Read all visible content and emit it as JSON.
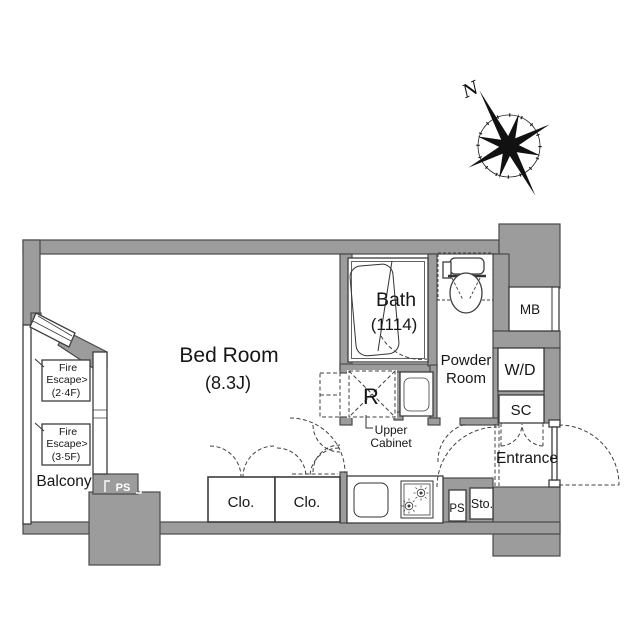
{
  "colors": {
    "wall_fill": "#9c9c9c",
    "wall_outline": "#4a4a4a",
    "line": "#333333",
    "text": "#161616",
    "background": "#ffffff"
  },
  "compass": {
    "north_label": "N"
  },
  "labels": {
    "bedroom_name": "Bed Room",
    "bedroom_size": "(8.3J)",
    "bath_name": "Bath",
    "bath_size": "(1114)",
    "powder_room_line1": "Powder",
    "powder_room_line2": "Room",
    "entrance": "Entrance",
    "balcony": "Balcony",
    "closet1": "Clo.",
    "closet2": "Clo.",
    "refrigerator": "R",
    "upper_cabinet_line1": "Upper",
    "upper_cabinet_line2": "Cabinet",
    "meter_box": "MB",
    "washer_dryer": "W/D",
    "shoe_closet": "SC",
    "storage": "Sto.",
    "pipe_shaft_left": "PS",
    "pipe_shaft_right": "PS",
    "fire_escape_upper": {
      "line1": "Fire",
      "line2": "Escape>",
      "floors": "(2·4F)"
    },
    "fire_escape_lower": {
      "line1": "Fire",
      "line2": "Escape>",
      "floors": "(3·5F)"
    }
  }
}
